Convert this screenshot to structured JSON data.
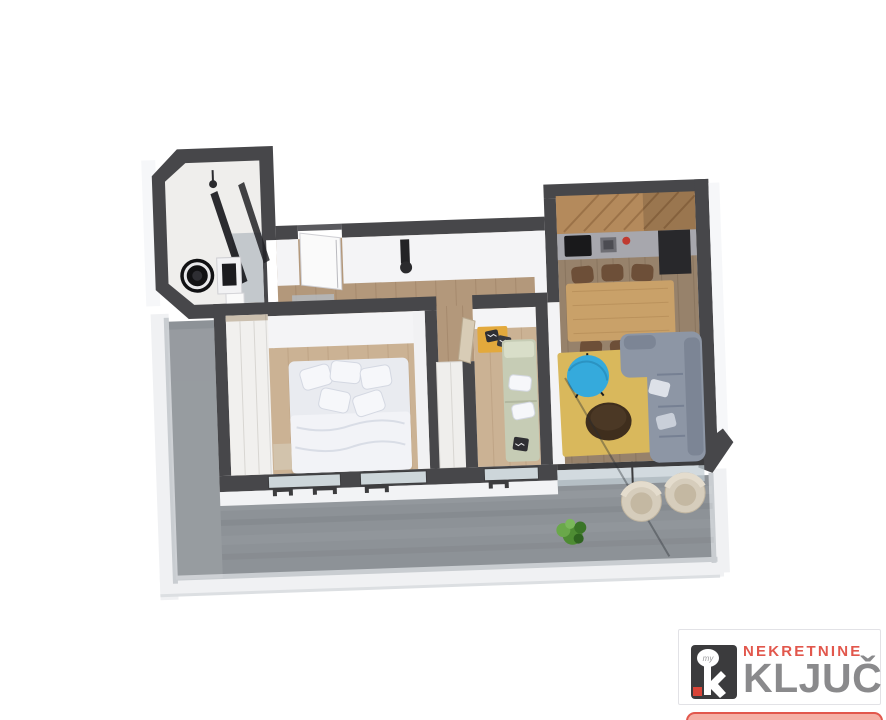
{
  "scene": {
    "kind": "3d-isometric-floorplan-render",
    "background": "#ffffff"
  },
  "floorplan": {
    "wall_top_color": "#47474a",
    "wall_face_color": "#f4f4f6",
    "rooms": [
      {
        "id": "bathroom",
        "floor_color": "#efeeec"
      },
      {
        "id": "hallway",
        "floor_color": "#b3987b"
      },
      {
        "id": "kitchen",
        "floor_color": "#97826b"
      },
      {
        "id": "dining-area",
        "floor_color": "#97826b"
      },
      {
        "id": "living-room",
        "floor_color": "#97826b"
      },
      {
        "id": "bedroom",
        "floor_color": "#cbb294"
      },
      {
        "id": "kids-room",
        "floor_color": "#cbb294"
      },
      {
        "id": "terrace",
        "floor_color": "#8d9297"
      }
    ],
    "accent_colors": {
      "rug": "#d9b85c",
      "sofa": "#8d96a5",
      "side_table_blue": "#35aadc",
      "coffee_table": "#3f2e1d",
      "dining_table": "#c9a169",
      "chair": "#6d4f38",
      "kitchen_wood": "#b48a5c",
      "appliance_black": "#19191b",
      "daybed_sage": "#c6ccb5",
      "bench_yellow": "#e3a93c",
      "bedding_white": "#e9ebf0",
      "armchair_beige": "#d6cdbc",
      "plant_green": "#4e8c33",
      "terrace_gray": "#8d9297"
    }
  },
  "logo": {
    "line1": "NEKRETNINE",
    "line2": "KLJUČ",
    "key_text": "my",
    "line1_color": "#e2574c",
    "line2_color": "#8a8a8c",
    "key_box_color": "#3b3b3d",
    "key_accent_red": "#d94438",
    "banner_fill": "#f5b0a6",
    "banner_border": "#e2574c"
  }
}
